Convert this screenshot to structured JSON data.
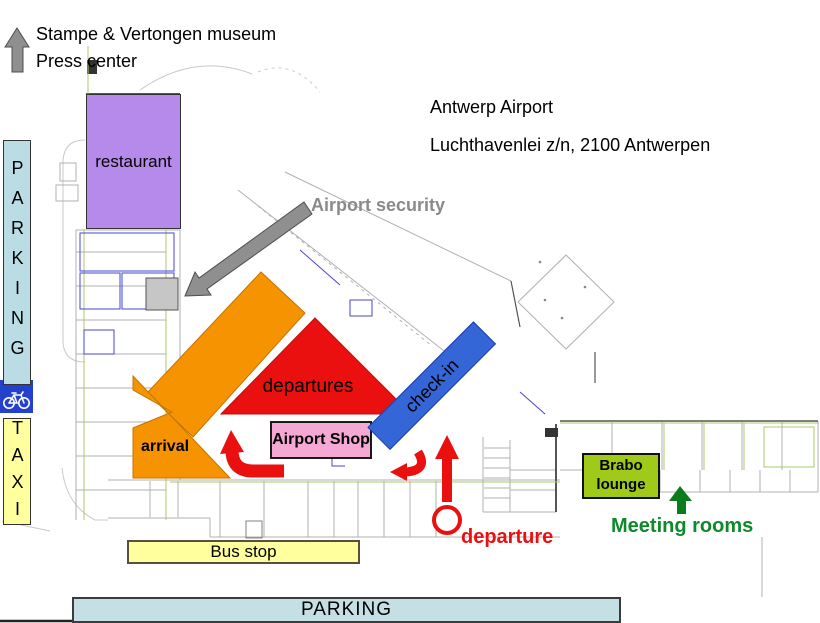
{
  "header": {
    "museum_line1": "Stampe & Vertongen museum",
    "museum_line2": "Press center",
    "airport_name": "Antwerp Airport",
    "airport_address": "Luchthavenlei z/n, 2100 Antwerpen"
  },
  "zones": {
    "restaurant": "restaurant",
    "departures": "departures",
    "arrival": "arrival",
    "airport_shop": "Airport Shop",
    "check_in": "check-in",
    "brabo_line1": "Brabo",
    "brabo_line2": "lounge"
  },
  "annotations": {
    "security": "Airport security",
    "departure": "departure",
    "meeting_rooms": "Meeting rooms"
  },
  "transport": {
    "parking_west": "PARKING",
    "taxi": "TAXI",
    "bus_stop": "Bus stop",
    "parking_south": "PARKING"
  },
  "icons": {
    "museum_direction": "up-arrow-icon",
    "security_direction": "diagonal-arrow-icon",
    "bicycle": "bicycle-icon",
    "arrival_flow": "curved-arrow-icon",
    "checkin_flow": "curved-arrow-icon",
    "departure_flow": "up-arrow-icon",
    "departure_point": "circle-marker-icon",
    "meeting_direction": "up-arrow-icon"
  },
  "colors": {
    "parking_west": "#badde5",
    "taxi_bus_yellow": "#ffff9e",
    "parking_south": "#c4e0e5",
    "restaurant_purple": "#b58aea",
    "zone_orange": "#f59300",
    "flow_red": "#ea1010",
    "shop_pink": "#f6a8d4",
    "checkin_blue": "#3566d8",
    "brabo_green": "#a0ca1a",
    "meeting_green": "#0d8a2a",
    "security_gray": "#8a8a8a",
    "bike_blue": "#2441cb"
  }
}
